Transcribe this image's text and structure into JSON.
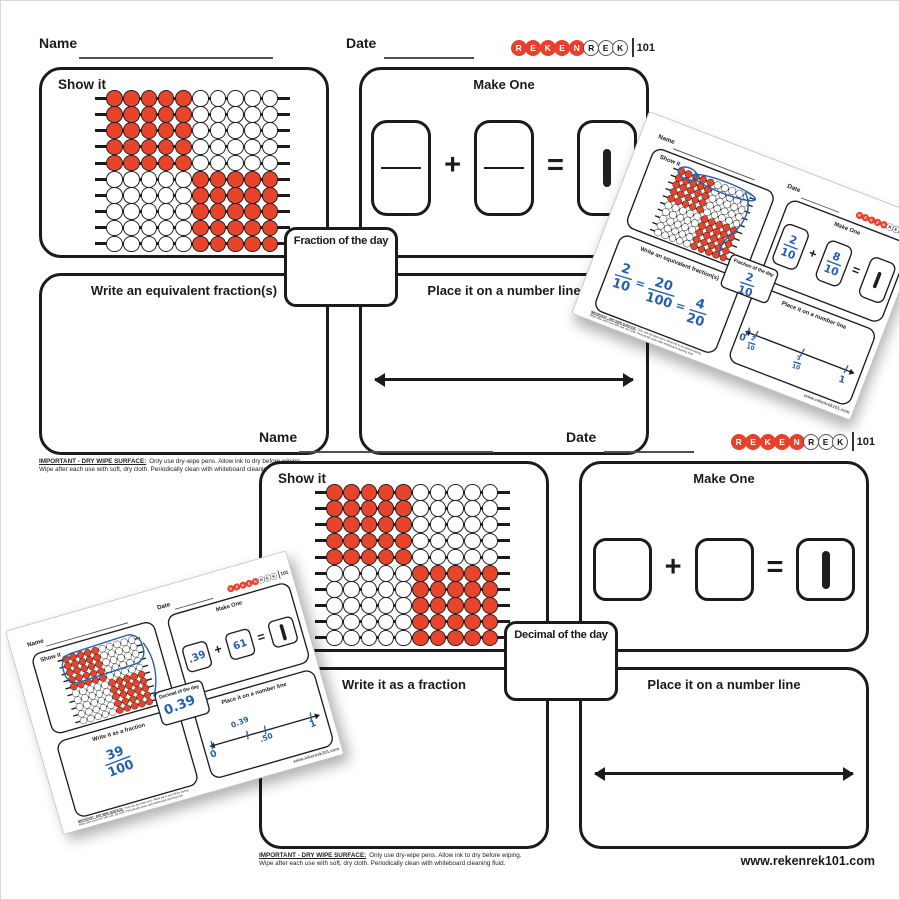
{
  "shared": {
    "name_label": "Name",
    "date_label": "Date",
    "show_it_label": "Show it",
    "make_one_label": "Make One",
    "number_line_label": "Place it on a number line",
    "plus_sign": "+",
    "equals_sign": "=",
    "fine_print_heading": "IMPORTANT - DRY WIPE SURFACE:",
    "fine_print_line1": "Only use dry-wipe pens. Allow ink to dry before wiping.",
    "fine_print_line2": "Wipe after each use with soft, dry cloth. Periodically clean with whiteboard cleaning fluid.",
    "website": "www.rekenrek101.com",
    "logo": {
      "red_letters": "REKEN",
      "outline_letters": "REK",
      "suffix": "101"
    }
  },
  "colors": {
    "bead_red": "#e8432b",
    "ink_blue": "#2460ae",
    "line_black": "#1b1b1b"
  },
  "rekenrek": {
    "rows": [
      "RRRRRWWWWW",
      "RRRRRWWWWW",
      "RRRRRWWWWW",
      "RRRRRWWWWW",
      "RRRRRWWWWW",
      "WWWWWRRRRR",
      "WWWWWRRRRR",
      "WWWWWRRRRR",
      "WWWWWRRRRR",
      "WWWWWRRRRR"
    ]
  },
  "fraction_sheet": {
    "center_label": "Fraction of the day",
    "left_panel_label": "Write an equivalent fraction(s)"
  },
  "decimal_sheet": {
    "center_label": "Decimal of the day",
    "left_panel_label": "Write it as a fraction"
  },
  "filled_fraction": {
    "make_one_addend1": {
      "num": "2",
      "den": "10"
    },
    "make_one_addend2": {
      "num": "8",
      "den": "10"
    },
    "day_fraction": {
      "num": "2",
      "den": "10"
    },
    "equivalent": {
      "f1": {
        "num": "2",
        "den": "10"
      },
      "eq1": "=",
      "f2": {
        "num": "20",
        "den": "100"
      },
      "eq2": "=",
      "f3": {
        "num": "4",
        "den": "20"
      }
    },
    "number_line": {
      "zero": "0",
      "tick1": {
        "num": "2",
        "den": "10"
      },
      "tick2": {
        "num": "5",
        "den": "10"
      },
      "one": "1"
    }
  },
  "filled_decimal": {
    "make_one_addend1": ".39",
    "make_one_addend2": "61",
    "day_value": "0.39",
    "fraction": {
      "num": "39",
      "den": "100"
    },
    "number_line": {
      "zero": "0",
      "above": "0.39",
      "mid": ".50",
      "one": "1"
    }
  }
}
